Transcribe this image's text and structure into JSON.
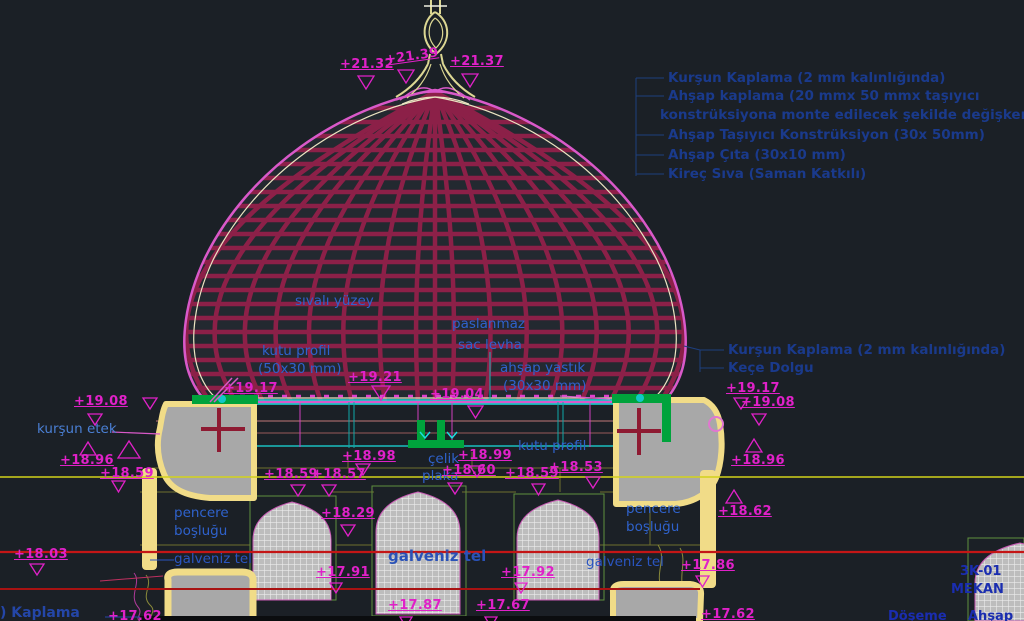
{
  "legend": {
    "items": [
      "Kurşun Kaplama (2 mm kalınlığında)",
      "Ahşap kaplama (20 mmx 50 mmx taşıyıcı",
      "konstrüksiyona monte edilecek şekilde değişken)",
      "Ahşap Taşıyıcı Konstrüksiyon (30x 50mm)",
      "Ahşap Çıta (30x10 mm)",
      "Kireç Sıva (Saman Katkılı)"
    ]
  },
  "callouts": {
    "sivali_yuzey": "sıvalı yüzey",
    "paslanmaz": "paslanmaz",
    "sac_levha": "sac levha",
    "kutu_profil": "kutu profil",
    "kutu_profil_size": "(50x30 mm)",
    "ahsap_yastik": "ahşap yastık",
    "ahsap_yastik_size": "(30x30 mm)",
    "kursun_kaplama": "Kurşun Kaplama (2 mm kalınlığında)",
    "kece_dolgu": "Keçe Dolgu",
    "kursun_etek": "kurşun etek",
    "kutu_profil_2": "kutu profil",
    "celik": "çelik",
    "plaka": "plaka",
    "pencere_l1": "pencere",
    "pencere_l2": "boşluğu",
    "pencere_r1": "pencere",
    "pencere_r2": "boşluğu",
    "galveniz_left": "galveniz tel",
    "galveniz_center": "galveniz tel",
    "galveniz_right": "galveniz tel",
    "kaplama_fragment": ") Kaplama",
    "sheet_code": "3K-01",
    "sheet_name": "MEKAN",
    "doseme": "Döşeme",
    "ahsap_fragment": "Ahşap"
  },
  "elevations": [
    "+21.32",
    "+21.39",
    "+21.37",
    "+19.21",
    "+19.04",
    "+19.17",
    "+19.08",
    "+18.96",
    "+18.59",
    "+18.98",
    "+18.59",
    "+18.57",
    "+18.99",
    "+18.60",
    "+18.59",
    "+18.53",
    "+19.17",
    "+19.08",
    "+18.96",
    "+18.62",
    "+18.29",
    "+18.03",
    "+17.91",
    "+17.92",
    "+17.86",
    "+17.87",
    "+17.67",
    "+17.62",
    "+17.62"
  ],
  "colors": {
    "background": "#1b2026",
    "elevation_text": "#e021c8",
    "callout_blue": "#2f62cc",
    "legend_blue": "#1a3a8c",
    "grid_crimson": "#8c2048",
    "outline_pink": "#d959c9",
    "cyan": "#1adede",
    "green": "#00a33c",
    "stone_gray": "#a8a8a8",
    "stone_outline": "#f1dc88",
    "level_yellow": "#d2d21a",
    "level_red": "#c41616"
  }
}
